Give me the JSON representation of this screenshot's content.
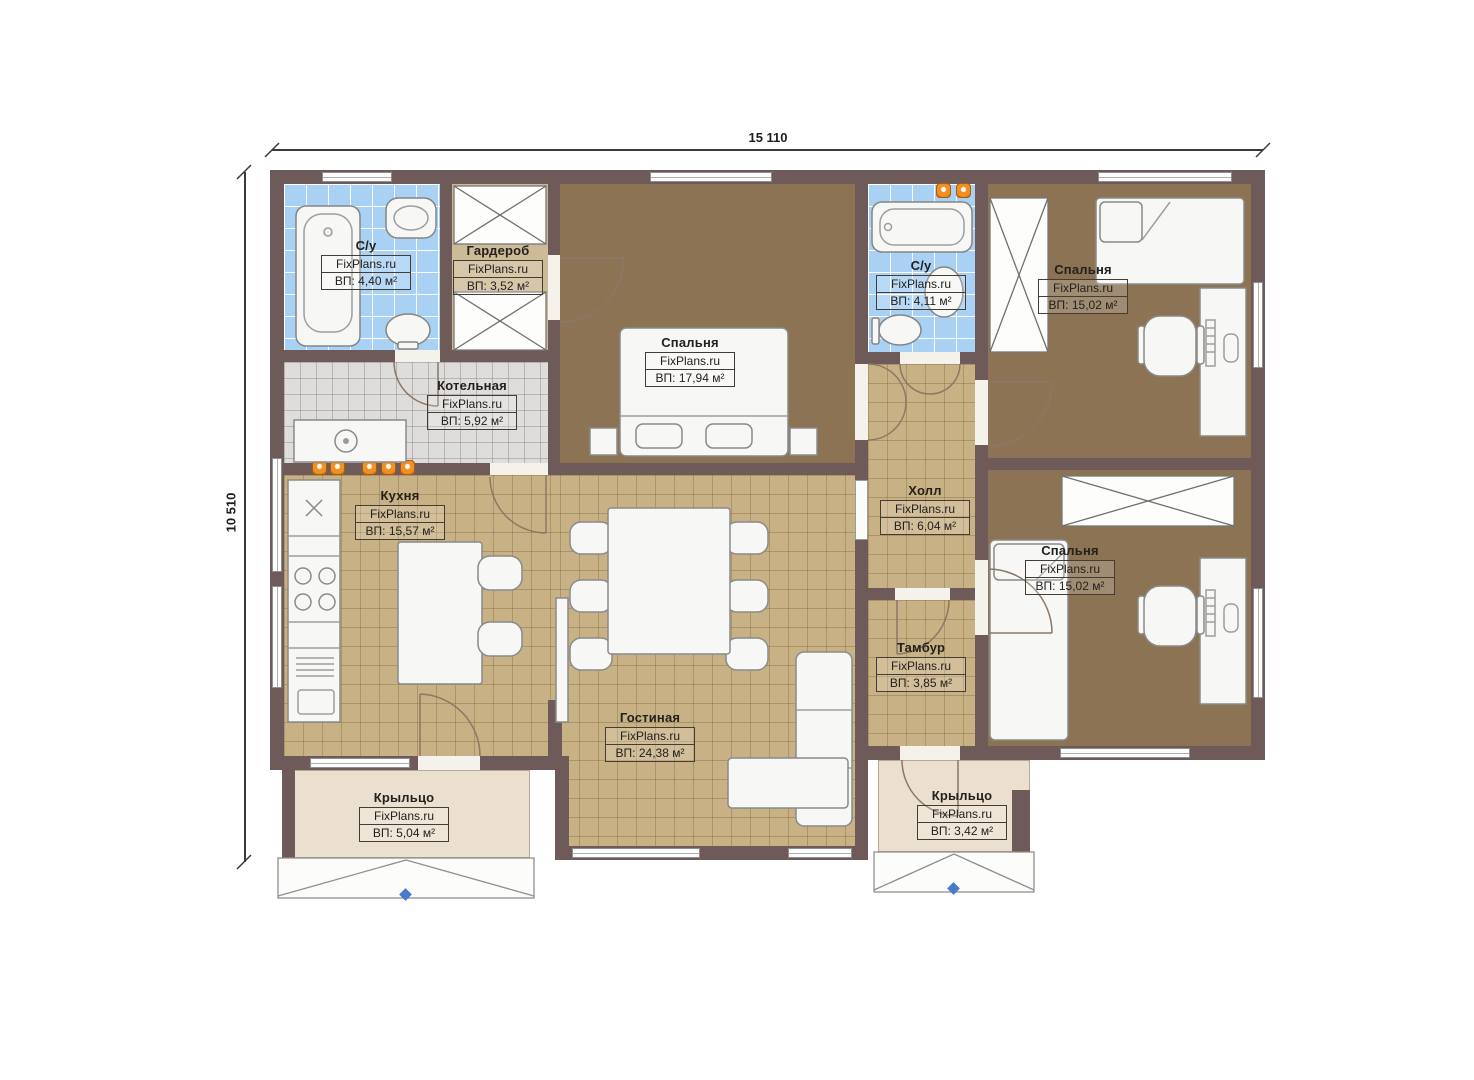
{
  "title": "House floor plan",
  "watermark": "FixPlans.ru",
  "dimensions": {
    "width_label": "15 110",
    "height_label": "10 510"
  },
  "rooms": [
    {
      "id": "bathroom-1",
      "name": "С/у",
      "area": "ВП: 4,40 м²"
    },
    {
      "id": "wardrobe",
      "name": "Гардероб",
      "area": "ВП: 3,52 м²"
    },
    {
      "id": "boiler-room",
      "name": "Котельная",
      "area": "ВП: 5,92 м²"
    },
    {
      "id": "bedroom-1",
      "name": "Спальня",
      "area": "ВП: 17,94 м²"
    },
    {
      "id": "bathroom-2",
      "name": "С/у",
      "area": "ВП: 4,11 м²"
    },
    {
      "id": "bedroom-2",
      "name": "Спальня",
      "area": "ВП: 15,02 м²"
    },
    {
      "id": "kitchen",
      "name": "Кухня",
      "area": "ВП: 15,57 м²"
    },
    {
      "id": "hall",
      "name": "Холл",
      "area": "ВП: 6,04 м²"
    },
    {
      "id": "bedroom-3",
      "name": "Спальня",
      "area": "ВП: 15,02 м²"
    },
    {
      "id": "vestibule",
      "name": "Тамбур",
      "area": "ВП: 3,85 м²"
    },
    {
      "id": "living-room",
      "name": "Гостиная",
      "area": "ВП: 24,38 м²"
    },
    {
      "id": "porch-left",
      "name": "Крыльцо",
      "area": "ВП: 5,04 м²"
    },
    {
      "id": "porch-right",
      "name": "Крыльцо",
      "area": "ВП: 3,42 м²"
    }
  ],
  "colors": {
    "wall": "#6e5b59",
    "bedroom_floor": "#8b7353",
    "tile_floor": "#c8b184",
    "bathroom_tile": "#a9d1f3",
    "boiler_tile": "#dedddb",
    "porch_floor": "#ebe0cf",
    "radiator": "#f09021",
    "marker_blue": "#4a79c9"
  }
}
